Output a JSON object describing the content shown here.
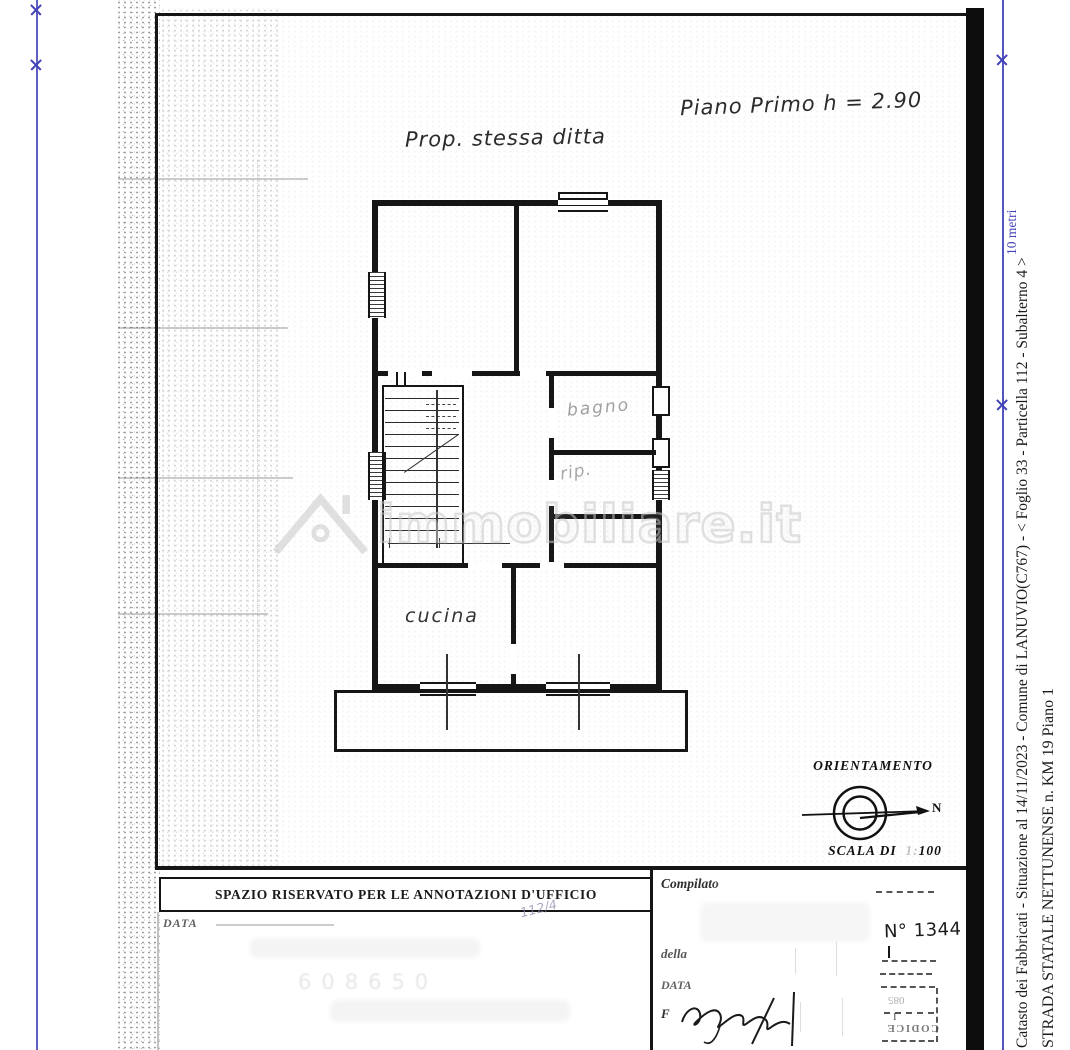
{
  "rulers": {
    "right_label": "10 metri",
    "ruler_color": "#4343b8"
  },
  "margin": {
    "line1": "Catasto dei Fabbricati - Situazione al 14/11/2023 - Comune di LANUVIO(C767) - <  Foglio 33 - Particella  112 - Subalterno 4 >",
    "line2": "STRADA STATALE NETTUNENSE n. KM 19 Piano 1"
  },
  "plan": {
    "floor_note": "Piano Primo h = 2.90",
    "ownership_note": "Prop. stessa ditta",
    "rooms": {
      "bathroom": "bagno",
      "storage": "rip.",
      "kitchen": "cucina"
    }
  },
  "orientation": {
    "title": "ORIENTAMENTO",
    "north": "N",
    "scale_prefix": "SCALA DI",
    "scale_faint": "1:",
    "scale_value": "100"
  },
  "watermark": {
    "text": "immobiliare.it"
  },
  "footer": {
    "annotations_title": "SPAZIO RISERVATO PER LE ANNOTAZIONI D'UFFICIO",
    "data_label": "DATA",
    "handwritten_ref": "112/4",
    "faint_stamp": "608650",
    "office": {
      "compilato_label": "Compilato",
      "della_label": "della",
      "data_label": "DATA",
      "firma_label": "F",
      "protocol_number": "N° 1344",
      "codice_stamp": "CODICE",
      "mark_i": "I",
      "mark_digits": "085"
    }
  },
  "colors": {
    "wall": "#161616",
    "pencil": "#9a9a9a",
    "watermark_stroke": "#c8c8c8",
    "ruler_blue": "#4343b8"
  }
}
